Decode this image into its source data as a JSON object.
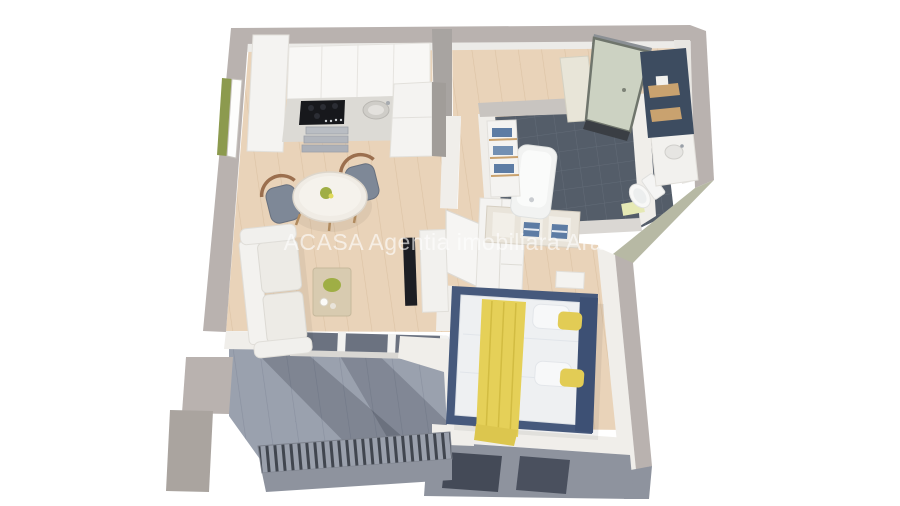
{
  "watermark": {
    "text": "ACASA Agentia imobiliara Arad",
    "color": "#ffffff",
    "opacity": 0.62
  },
  "scene": {
    "type": "3d-floor-plan-render",
    "background": "#ffffff",
    "palette": {
      "wall_top": "#b9b2af",
      "wall_top_dark": "#aaa49f",
      "wall_face": "#8e939e",
      "wall_olive": "#b7b9a4",
      "interior_wall": "#f0eeea",
      "wood_floor": "#e9d3b9",
      "wood_floor_line": "#dcc3a4",
      "bathroom_tile": "#545d69",
      "bathroom_tile_line": "#626b77",
      "balcony_floor": "#9aa1ae",
      "balcony_line": "#8a91a0",
      "accent_navy": "#3d4c60",
      "bed_frame_navy": "#46597c",
      "blanket_yellow": "#e5d058",
      "towel_blue": "#5d7ca4",
      "door_green": "#ccd2c2",
      "wood_accent": "#c9a26f",
      "grass_green": "#8c9a4e",
      "cooktop_black": "#17181c",
      "tv_black": "#1d1e23",
      "chair_gray": "#7e8897",
      "counter_marble": "#dcdad5",
      "coffee_table": "#d8cbb0",
      "plant_green": "#9fae45"
    },
    "rooms": [
      {
        "name": "kitchen-living",
        "floor": "wood",
        "furniture": [
          "tall-cabinet",
          "upper-cabinets",
          "cooktop",
          "sink",
          "metal-drawers",
          "fridge",
          "dining-table",
          "chair",
          "chair",
          "sofa",
          "coffee-table",
          "tv",
          "tv-console",
          "balcony-glass-doors",
          "west-window"
        ]
      },
      {
        "name": "hallway",
        "floor": "wood",
        "furniture": [
          "entry-door",
          "navy-accent-wall",
          "wood-shelves",
          "mirror-panel"
        ]
      },
      {
        "name": "bathroom",
        "floor": "dark-tile",
        "furniture": [
          "bathtub",
          "toilet",
          "vanity-basin",
          "towel-shelf",
          "towel-dresser",
          "bath-mat"
        ]
      },
      {
        "name": "bedroom",
        "floor": "wood",
        "furniture": [
          "double-bed",
          "yellow-throw",
          "pillows",
          "wardrobe",
          "nightstand",
          "south-windows"
        ]
      },
      {
        "name": "balcony",
        "floor": "gray-tile",
        "furniture": [
          "slatted-railing"
        ]
      }
    ]
  }
}
